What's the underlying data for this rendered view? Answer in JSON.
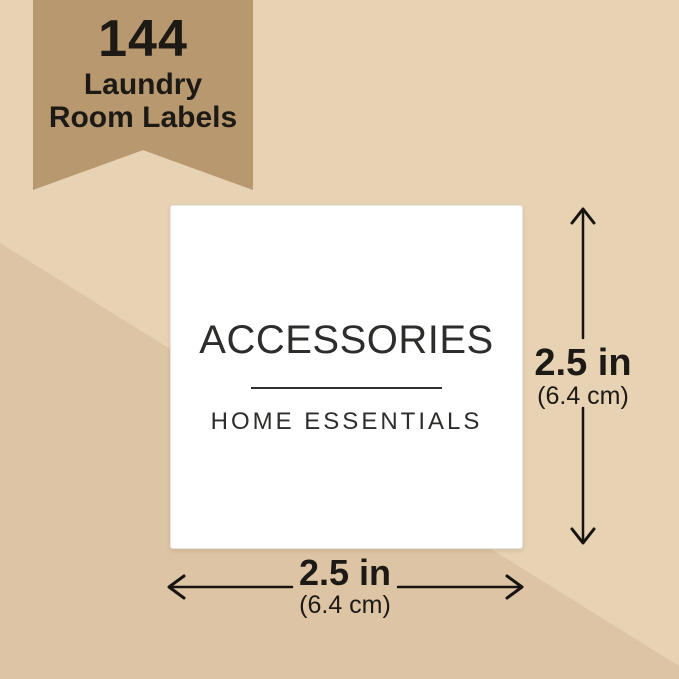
{
  "badge": {
    "count": "144",
    "line2": "Laundry",
    "line3": "Room Labels"
  },
  "label_card": {
    "title": "ACCESSORIES",
    "subtitle": "HOME ESSENTIALS"
  },
  "dimensions": {
    "height": {
      "value": "2.5 in",
      "metric": "(6.4 cm)"
    },
    "width": {
      "value": "2.5 in",
      "metric": "(6.4 cm)"
    }
  },
  "colors": {
    "background_light": "#e7d2b4",
    "background_dark": "#dcc4a4",
    "badge": "#b8986f",
    "ink": "#1d1a15",
    "card": "#ffffff",
    "card_ink": "#2e2d2b"
  }
}
